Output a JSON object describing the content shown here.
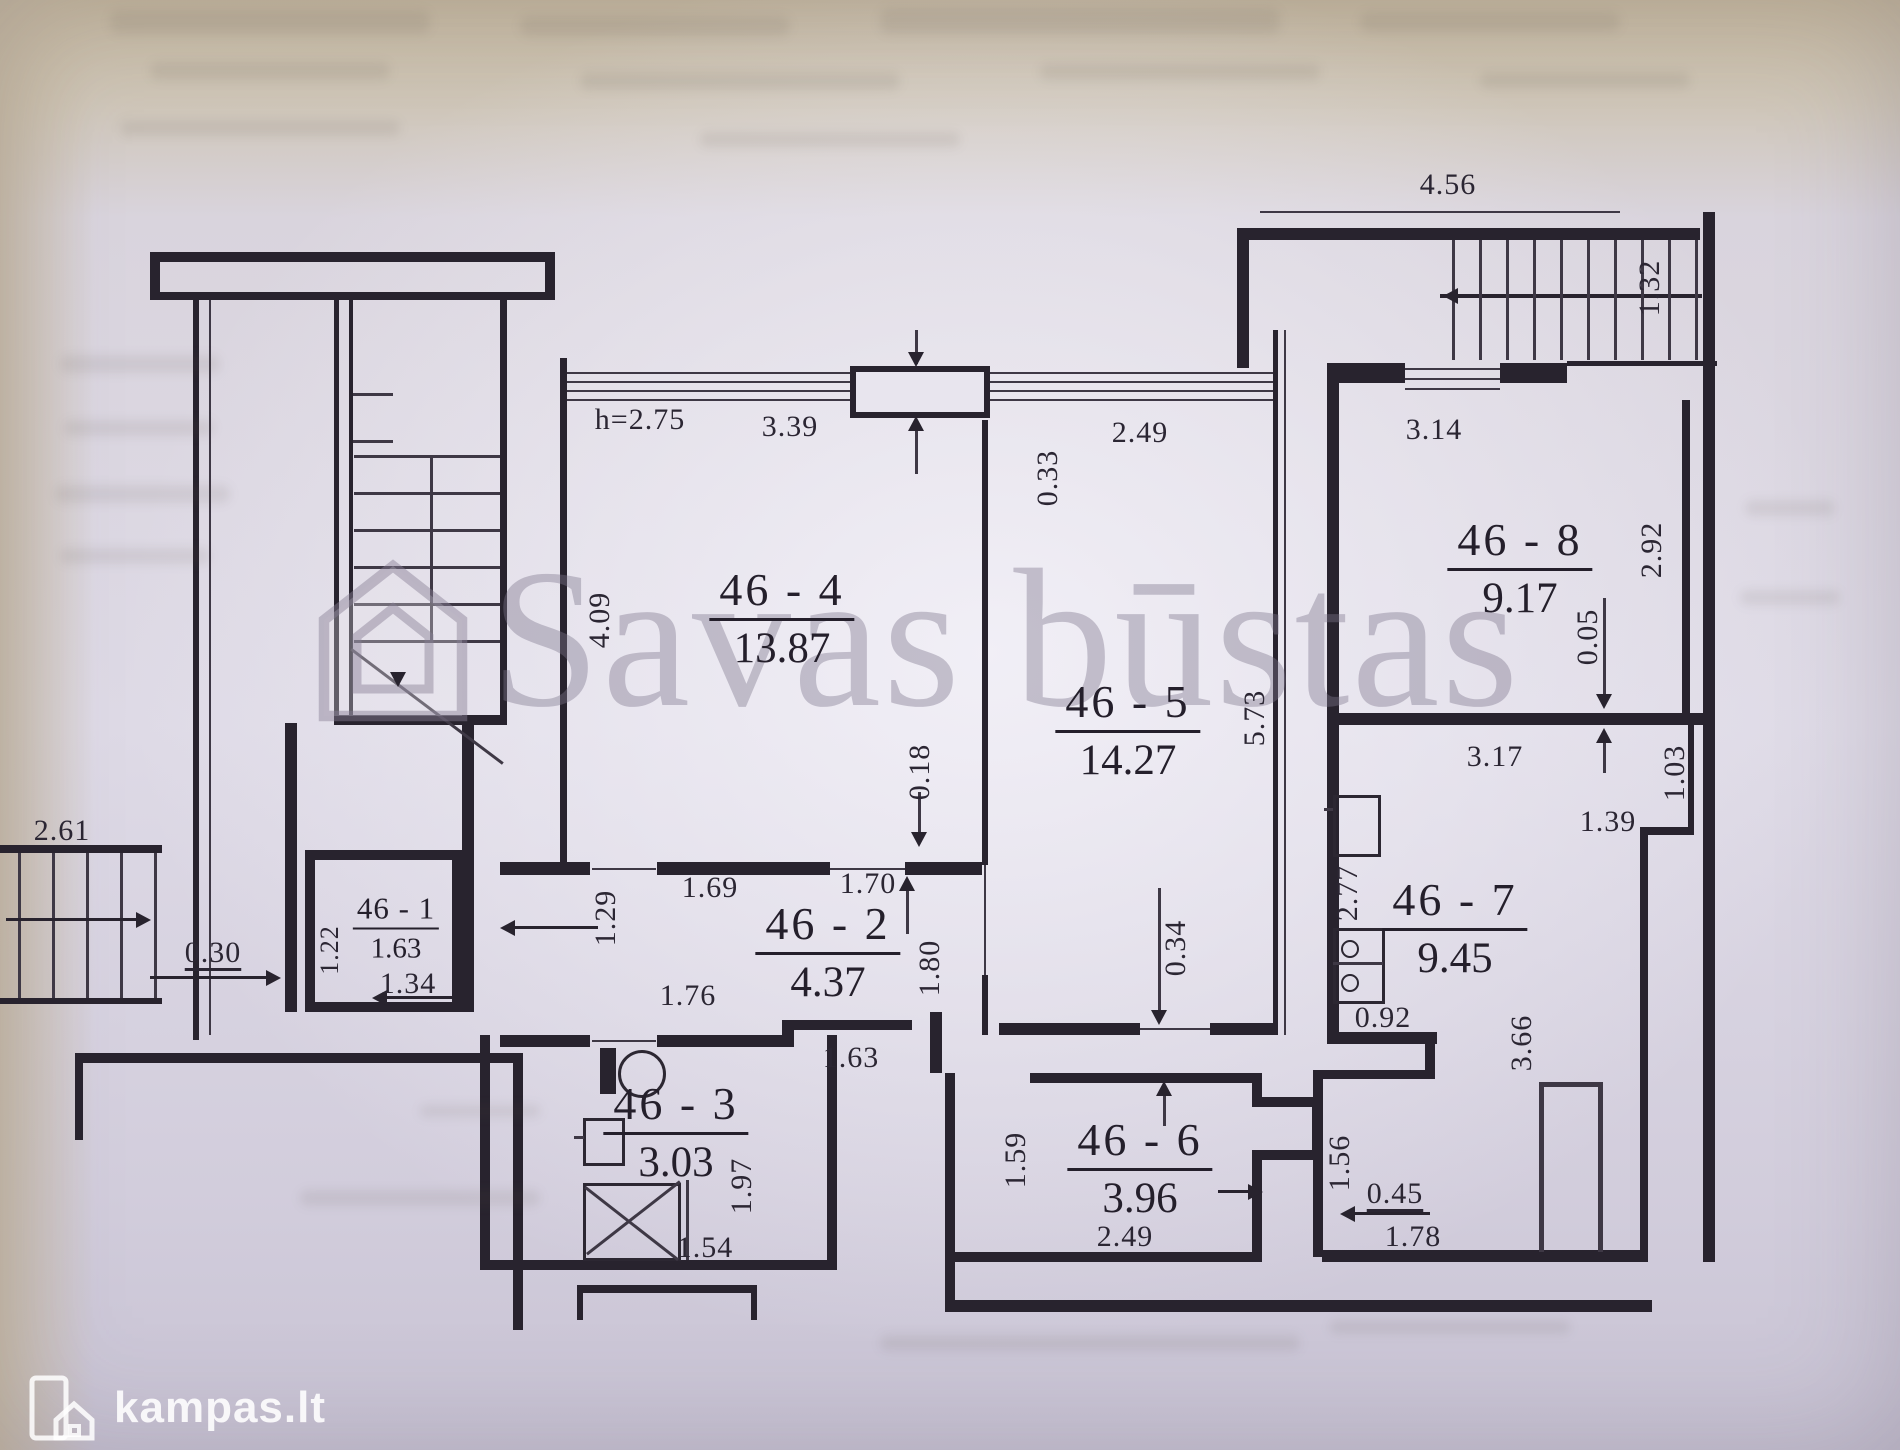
{
  "watermark": {
    "text": "Savas būstas"
  },
  "brand": {
    "logo_text": "kampas.lt"
  },
  "plan": {
    "ceiling_height_label": "h=2.75",
    "rooms": [
      {
        "id": "46 - 1",
        "area": "1.63"
      },
      {
        "id": "46 - 2",
        "area": "4.37"
      },
      {
        "id": "46 - 3",
        "area": "3.03"
      },
      {
        "id": "46 - 4",
        "area": "13.87"
      },
      {
        "id": "46 - 5",
        "area": "14.27"
      },
      {
        "id": "46 - 6",
        "area": "3.96"
      },
      {
        "id": "46 - 7",
        "area": "9.45"
      },
      {
        "id": "46 - 8",
        "area": "9.17"
      }
    ],
    "dims": [
      "4.56",
      "1.32",
      "3.39",
      "0.33",
      "4.09",
      "2.49",
      "5.73",
      "3.14",
      "2.92",
      "0.05",
      "3.17",
      "1.03",
      "1.39",
      "2.77",
      "0.92",
      "3.66",
      "1.59",
      "1.56",
      "0.45",
      "1.78",
      "2.49",
      "1.69",
      "1.70",
      "1.80",
      "1.29",
      "1.76",
      "1.63",
      "0.18",
      "0.34",
      "2.61",
      "0.30",
      "1.34",
      "1.22",
      "1.97",
      "1.54"
    ]
  }
}
